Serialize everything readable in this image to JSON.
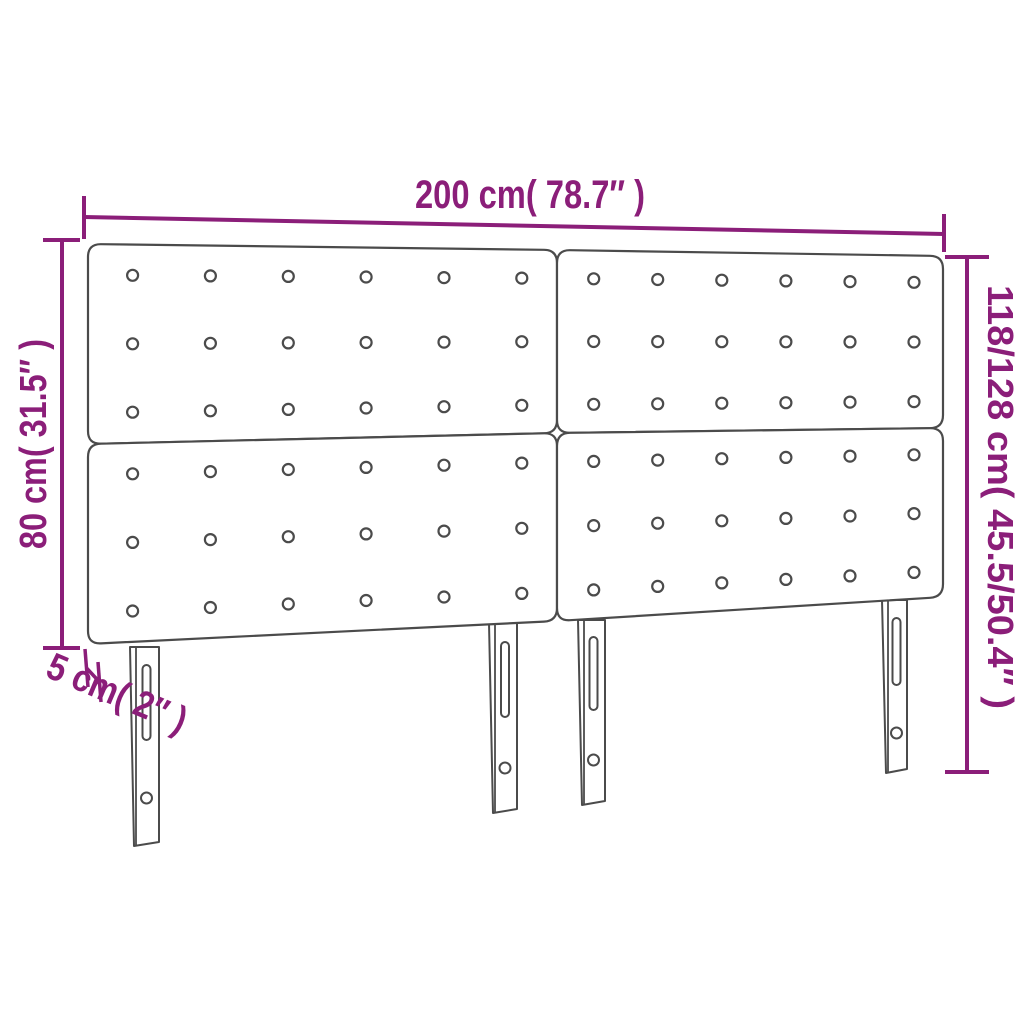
{
  "diagram": {
    "title": "Headboard dimension diagram",
    "accent_color": "#8B1E79",
    "outline_color": "#4B4B4B",
    "labels": {
      "width": "200 cm( 78.7″ )",
      "panel_height": "80 cm( 31.5″ )",
      "total_height": "118/128 cm( 45.5/50.4″ )",
      "thickness": "5 cm( 2″ )"
    },
    "structure": {
      "panel_count": 4,
      "button_columns_per_panel": 6,
      "button_rows_per_panel": 3,
      "leg_count": 4
    }
  }
}
